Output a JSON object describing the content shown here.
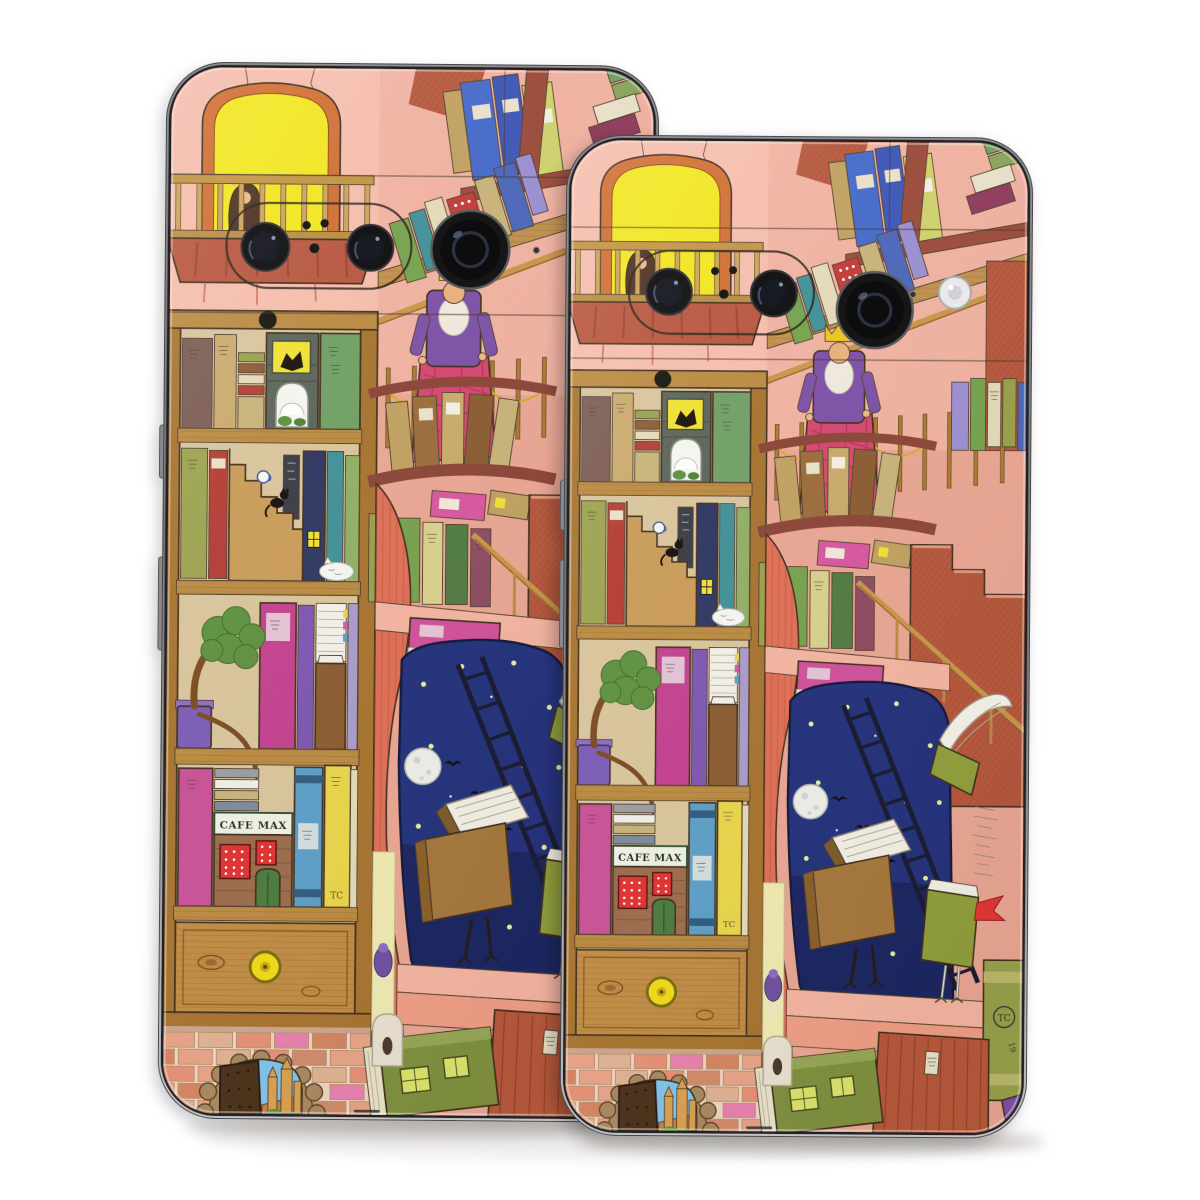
{
  "scene": {
    "background": "#ffffff",
    "shadow_color": "#b5b0ac"
  },
  "artwork": {
    "cafe_sign": "CAFE MAX",
    "book_monogram": "TC",
    "year_mark": "19",
    "palette": {
      "wall_salmon": "#f0b1a0",
      "wall_light": "#f5bcab",
      "wall_rose": "#e9a592",
      "window_glow": "#f2e51c",
      "window_frame": "#cf6c2e",
      "night_blue": "#22307a",
      "brick_red": "#b5573b",
      "curtain_red": "#de6e55",
      "wood": "#bf8f4c",
      "shelf_wood": "#a6722e",
      "firefly": "#e7f09a",
      "cafe_sign_bg": "#eef0e2",
      "moon": "#eceee8"
    }
  },
  "phones": {
    "left": {
      "frame_color": "#606064"
    },
    "right": {
      "frame_color": "#606064"
    }
  }
}
